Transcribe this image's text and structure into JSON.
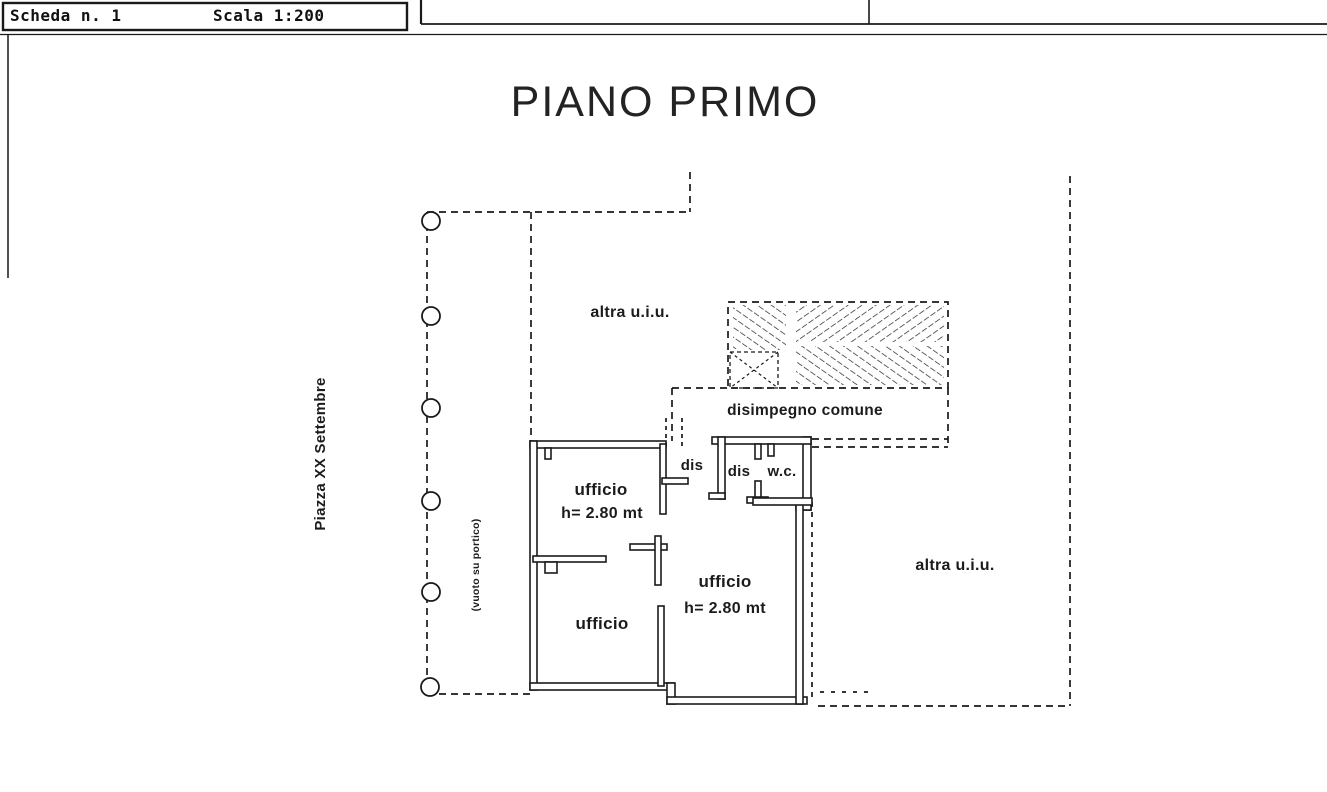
{
  "header": {
    "scheda": "Scheda n. 1",
    "scala": "Scala 1:200"
  },
  "title": "PIANO PRIMO",
  "street_label": "Piazza XX Settembre",
  "portico_label": "(vuoto su portico)",
  "rooms": {
    "altra_uiu_top": "altra u.i.u.",
    "altra_uiu_right": "altra u.i.u.",
    "disimpegno": "disimpegno comune",
    "dis_corridor": "dis",
    "dis_2": "dis",
    "wc": "w.c.",
    "ufficio_1": "ufficio",
    "ufficio_1_h": "h= 2.80 mt",
    "ufficio_2": "ufficio",
    "ufficio_2_h": "h= 2.80 mt",
    "ufficio_3": "ufficio"
  },
  "colors": {
    "ink": "#1a1a1a",
    "paper": "#ffffff"
  }
}
